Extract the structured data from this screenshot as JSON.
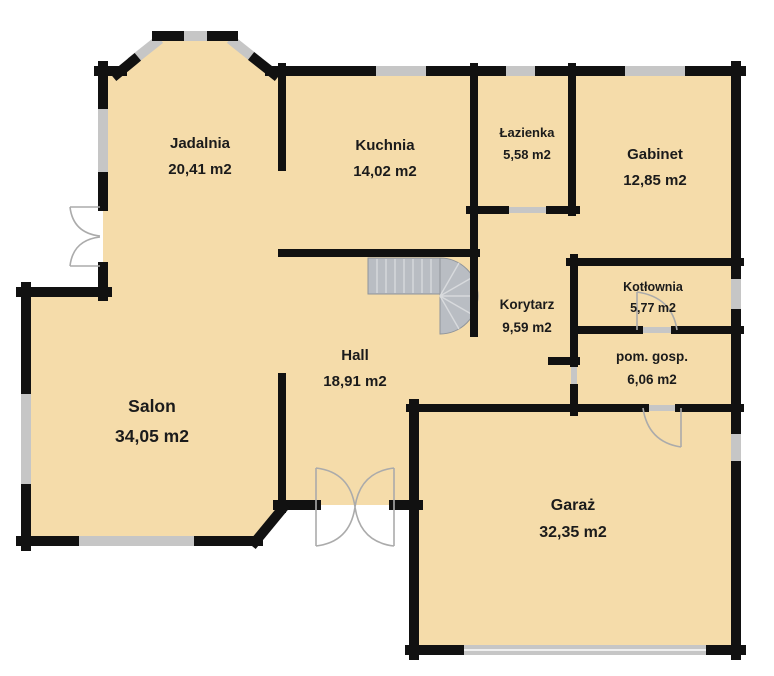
{
  "plan_title": "floor-plan",
  "unit": "m2",
  "colors": {
    "background": "#ffffff",
    "floor": "#f5dcaa",
    "wall": "#111111",
    "window": "#c6c6c6",
    "stair": "#b9bdc3",
    "stair_edge": "#8f949a",
    "door": "#ababab",
    "label": "#1b1b1b"
  },
  "rooms": [
    {
      "id": "jadalnia",
      "name": "Jadalnia",
      "area": "20,41 m2",
      "x": 200,
      "y": 131,
      "size": 15
    },
    {
      "id": "kuchnia",
      "name": "Kuchnia",
      "area": "14,02 m2",
      "x": 385,
      "y": 133,
      "size": 15
    },
    {
      "id": "lazienka",
      "name": "Łazienka",
      "area": "5,58 m2",
      "x": 527,
      "y": 122,
      "size": 13
    },
    {
      "id": "gabinet",
      "name": "Gabinet",
      "area": "12,85 m2",
      "x": 655,
      "y": 142,
      "size": 15
    },
    {
      "id": "kotlownia",
      "name": "Kotłownia",
      "area": "5,77 m2",
      "x": 653,
      "y": 277,
      "size": 12.5
    },
    {
      "id": "korytarz",
      "name": "Korytarz",
      "area": "9,59 m2",
      "x": 527,
      "y": 294,
      "size": 13.5
    },
    {
      "id": "pom-gosp",
      "name": "pom. gosp.",
      "area": "6,06 m2",
      "x": 652,
      "y": 346,
      "size": 13.5
    },
    {
      "id": "hall",
      "name": "Hall",
      "area": "18,91 m2",
      "x": 355,
      "y": 343,
      "size": 15
    },
    {
      "id": "salon",
      "name": "Salon",
      "area": "34,05 m2",
      "x": 152,
      "y": 392,
      "size": 17.5
    },
    {
      "id": "garaz",
      "name": "Garaż",
      "area": "32,35 m2",
      "x": 573,
      "y": 492,
      "size": 16
    }
  ]
}
